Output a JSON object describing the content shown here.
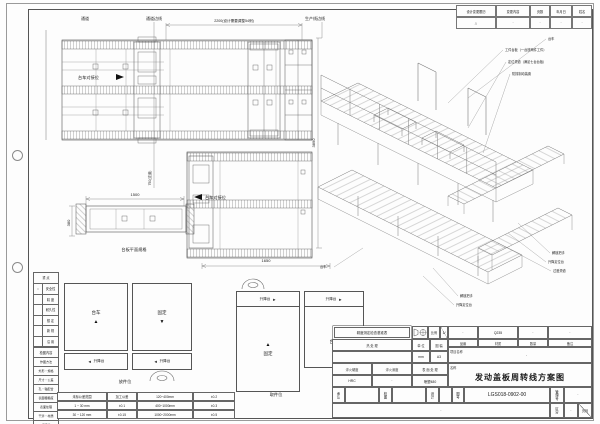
{
  "sheet": {
    "bg": "#fdfdfd",
    "line_color": "#666",
    "accent": "#222"
  },
  "icons": {
    "arrow_up": "▲",
    "arrow_down": "▼",
    "arrow_left": "◄",
    "arrow_right": "►",
    "triangle": "△",
    "dot": "·"
  },
  "revision_table": {
    "headers": [
      "设计变更履历",
      "变更内容",
      "页数",
      "年月日",
      "姓名"
    ],
    "row": [
      "△",
      "·",
      "·",
      "·",
      "·"
    ]
  },
  "plan_top": {
    "label_passage": "通道",
    "label_passage_edge": "通道边线",
    "label_production_edge": "生产线边线",
    "dim_top": "2200(设计需要调整54例)",
    "label_dock": "台车对接位",
    "dim_right": "3890"
  },
  "plan_lower": {
    "label_dock": "台车对接位",
    "dim_bottom": "1650",
    "dim_aisle": "750(过道)"
  },
  "side_view": {
    "dim_length": "1500",
    "dim_width": "380",
    "caption": "台板平面规格"
  },
  "checklist": {
    "header": "重 点",
    "items": [
      {
        "mark": "○",
        "label": "安全性"
      },
      {
        "mark": "",
        "label": "精 度"
      },
      {
        "mark": "",
        "label": "耐久性"
      },
      {
        "mark": "",
        "label": "想 定"
      },
      {
        "mark": "",
        "label": "新 规"
      },
      {
        "mark": "",
        "label": "沿 用"
      }
    ],
    "section2": "检图内容",
    "items2": [
      "作图方法",
      "外形・规格",
      "尺寸・公差",
      "孔・轴配合",
      "表面粗糙度",
      "表面处理",
      "干涉・材质",
      "标题栏"
    ]
  },
  "tolerance_table": {
    "rows": [
      [
        "未标公差范围",
        "加工公差",
        "120~400mm",
        "±0.2"
      ],
      [
        "1 ~ 30 mm",
        "±0.1",
        "400~1000mm",
        "±0.3"
      ],
      [
        "30 ~ 120 mm",
        "±0.15",
        "1000~2000mm",
        "±0.5"
      ]
    ]
  },
  "schematics": {
    "trolley": "台车",
    "fixed": "固定",
    "lift": "升降台",
    "pos1_label": "放件位",
    "pos2_label": "取件位"
  },
  "iso_view": {
    "callouts_top": [
      "台车",
      "工件台板（一台放两件工件）",
      "定位滑道（满足七台台板）",
      "防撞制动装置"
    ],
    "callouts_right": [
      "解锁把手",
      "升降定位台",
      "过渡滑道"
    ],
    "callouts_left": [
      "解锁把手",
      "升降定位台"
    ],
    "callout_trolley": "台车"
  },
  "title_block": {
    "stamp": "精度测定检查基准表",
    "scale_label": "比例",
    "scale_value": "1/",
    "heat_label": "热 处 理",
    "unit_label": "单 位",
    "unit_value": "mm",
    "sheet_label": "图 幅",
    "sheet_value": "A3",
    "part_no_label": "品番",
    "part_no_value": "·",
    "material_label": "材质",
    "material_value": "Q235",
    "qty_label": "数量",
    "qty_value": "·",
    "remark_label": "备注",
    "remark_value": "·",
    "project_label": "项目名称",
    "project_value": "·",
    "hardness_label": "淬火硬度",
    "hardness_value": "HRC",
    "depth_label": "淬火深度",
    "depth_value": "·",
    "surface_label": "表 面 处 理",
    "surface_value": "喷塑480",
    "name_label": "名称",
    "name_value": "发动盖板周转线方案图",
    "approve_label": "承认",
    "check_label": "校图",
    "design_label": "设计",
    "dwg_no_label": "图号",
    "dwg_no_value": "LGS018-0902-00",
    "mgmt_label": "管理号",
    "mgmt_value": "·",
    "class_label": "区分",
    "class_value": "·",
    "page_label": "页码",
    "sign_value": "·"
  }
}
